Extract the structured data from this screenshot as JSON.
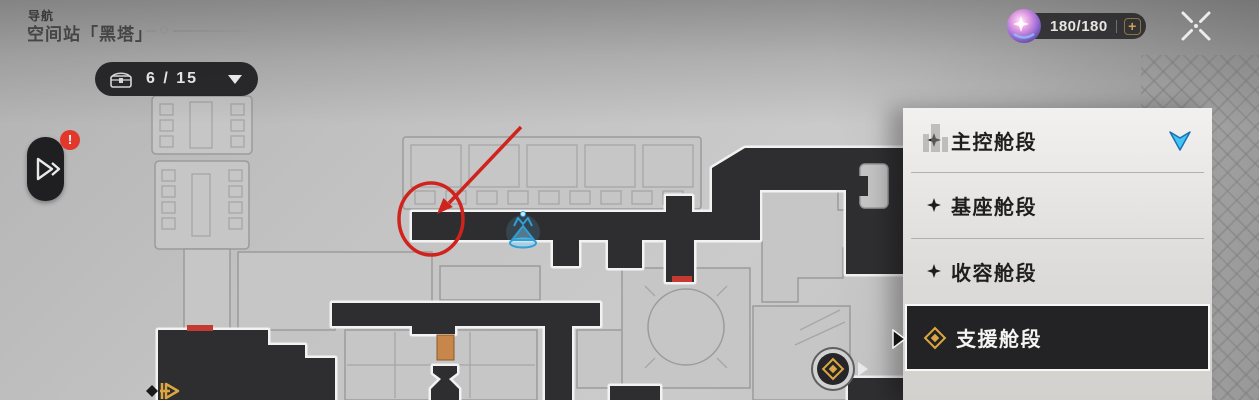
{
  "header": {
    "nav_label": "导航",
    "location_title": "空间站「黑塔」",
    "chest_dropdown": {
      "count": "6 / 15"
    },
    "stamina": {
      "value": "180/180",
      "plus_label": "+"
    }
  },
  "expand_button": {
    "badge": "!"
  },
  "panel": {
    "items": [
      {
        "label": "主控舱段",
        "selected": false
      },
      {
        "label": "基座舱段",
        "selected": false
      },
      {
        "label": "收容舱段",
        "selected": false
      },
      {
        "label": "支援舱段",
        "selected": true
      }
    ]
  },
  "map": {
    "markers": {
      "space_anchor": "blue-top-anchor",
      "teleport_medallion": "gold-medallion",
      "exit_arrow": "gold-exit-arrow"
    },
    "annotations": {
      "red_circle": true,
      "red_arrow": true
    }
  },
  "colors": {
    "annotation_red": "#d0231d",
    "anchor_blue": "#41c6f3",
    "gold": "#dca740",
    "badge_red": "#e2382c",
    "corridor_dark": "#2e2e30",
    "panel_light": "#f2f1ef"
  }
}
